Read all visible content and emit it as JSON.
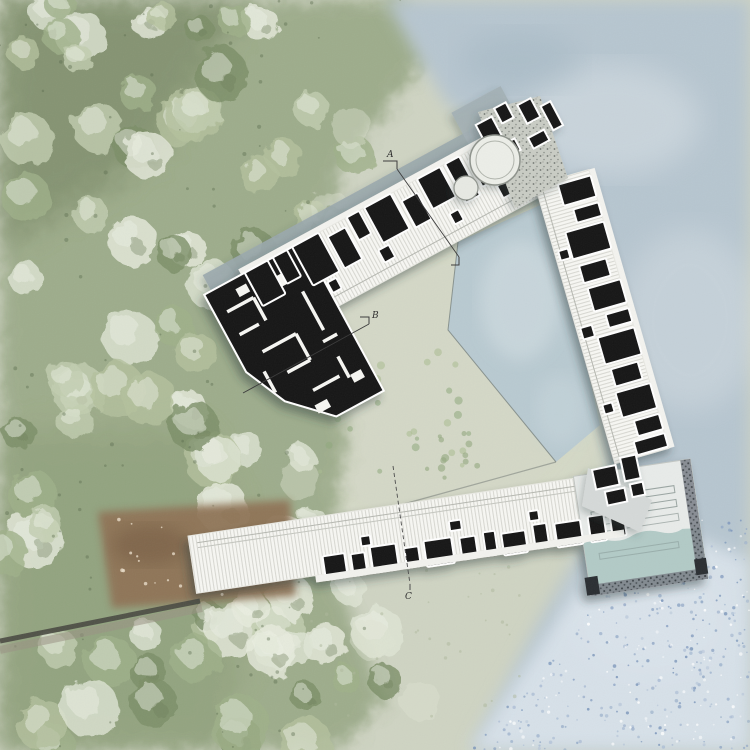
{
  "plan": {
    "kind": "architectural-site-plan",
    "section_markers": [
      {
        "label": "A"
      },
      {
        "label": "B"
      },
      {
        "label": "C"
      }
    ],
    "colors": {
      "meadow": "#cfd4c3",
      "forest": "#9cab8a",
      "forest_dark": "#72815f",
      "water": "#b7c6d0",
      "pond": "#b9cad1",
      "pool": "#b2cac6",
      "dirt": "#8f7357",
      "roof": "#f7f7f3",
      "rooms": "#171717",
      "gravel": "#c9ccc4",
      "band": "#9aa8ad"
    }
  }
}
